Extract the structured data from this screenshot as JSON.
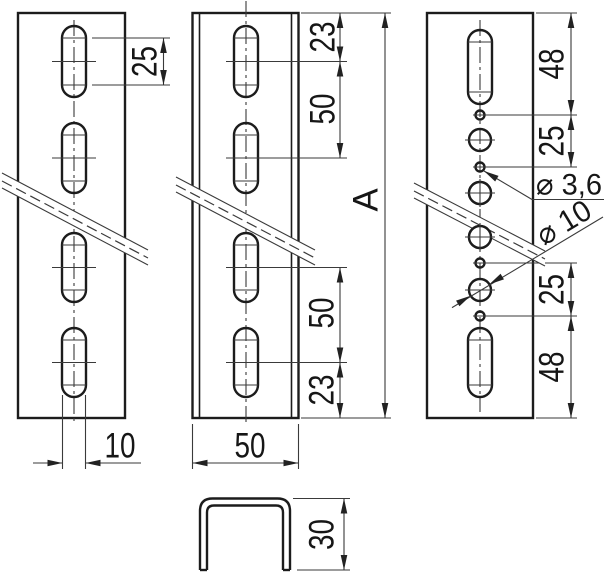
{
  "drawing": {
    "type": "technical-drawing",
    "part": "perforated mounting rail - two slotted views, hole-pattern view and U cross-section",
    "colors": {
      "background": "#ffffff",
      "line": "#1c1c1c",
      "thin_line": "#3a3a3a",
      "text": "#161616"
    },
    "views": {
      "left_rail": {
        "dimensions": {
          "slot_length": "25",
          "slot_width": "10"
        }
      },
      "middle_rail": {
        "dimensions": {
          "top_offset": "23",
          "upper_pitch": "50",
          "overall_length": "A",
          "lower_pitch": "50",
          "bottom_offset": "23",
          "width": "50"
        }
      },
      "right_rail": {
        "dimensions": {
          "top_offset": "48",
          "upper_hole_pitch": "25",
          "small_hole_diameter": "⌀ 3,6",
          "large_hole_diameter": "⌀ 10",
          "lower_hole_pitch": "25",
          "bottom_offset": "48"
        }
      },
      "cross_section": {
        "dimensions": {
          "height": "30"
        }
      }
    }
  }
}
